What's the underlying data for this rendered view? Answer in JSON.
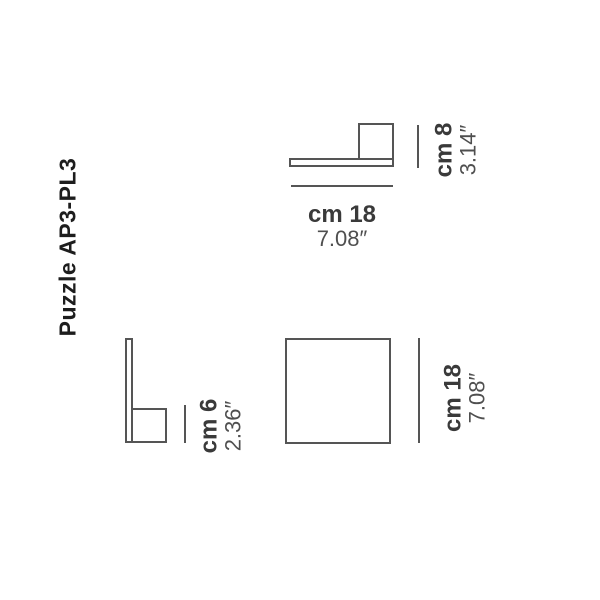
{
  "title": "Puzzle AP3-PL3",
  "colors": {
    "background": "#ffffff",
    "line": "#555555",
    "cm_text": "#3a3a3a",
    "inch_text": "#4f4f4f",
    "title_text": "#1d1d1d"
  },
  "views": {
    "top_side": {
      "width": {
        "cm": "cm 18",
        "inch": "7.08″"
      },
      "height": {
        "cm": "cm 8",
        "inch": "3.14″"
      }
    },
    "bottom_side": {
      "depth": {
        "cm": "cm 6",
        "inch": "2.36″"
      }
    },
    "front": {
      "height": {
        "cm": "cm 18",
        "inch": "7.08″"
      }
    }
  }
}
